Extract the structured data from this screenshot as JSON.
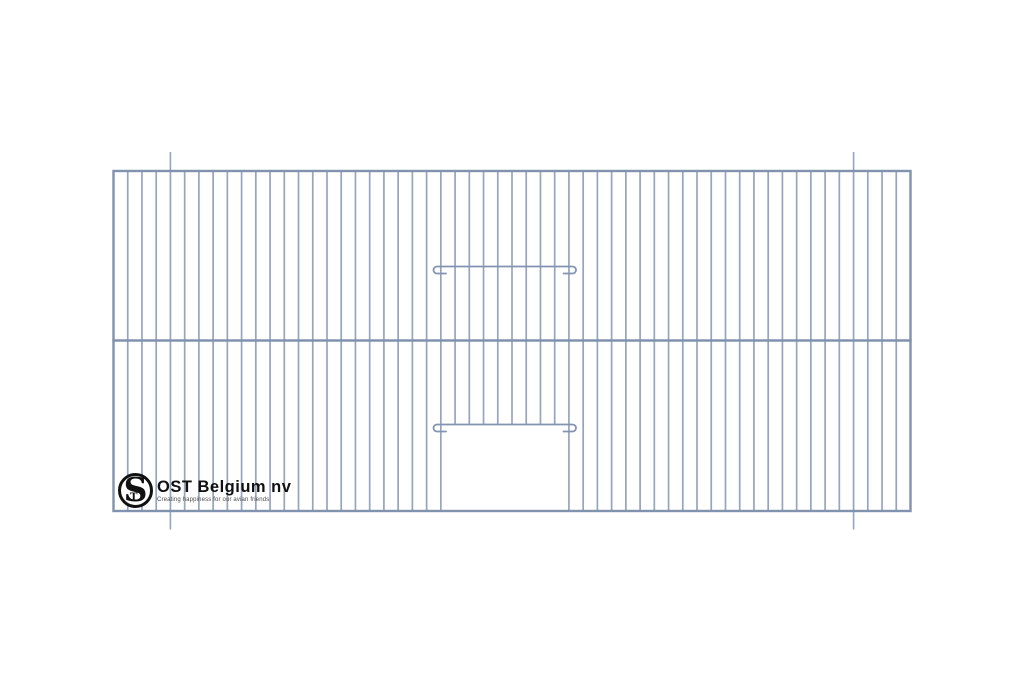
{
  "page": {
    "width": 1024,
    "height": 683,
    "background": "#ffffff"
  },
  "drawing": {
    "title": "cage-front-panel",
    "colors": {
      "frame": "#8192ae",
      "bar": "#96a4bd",
      "wire": "#8294b0",
      "mark": "#93a5c2"
    },
    "frame": {
      "left": 113.5,
      "top": 171,
      "right": 910.5,
      "bottom": 511,
      "stroke_width": 2.4
    },
    "mid_rail": {
      "y": 340.5,
      "stroke_width": 2.6
    },
    "bars": {
      "count": 55,
      "stroke_width": 1.7
    },
    "door": {
      "opening_left": 440.8,
      "opening_right": 568.9,
      "opening_top": 424.5,
      "wire_left": 437,
      "wire_right": 572.5,
      "hook_radius": 3.5,
      "hook_leg": 9,
      "wire_stroke_width": 1.8,
      "wires": [
        {
          "y": 266.5
        },
        {
          "y": 424.5
        }
      ]
    },
    "bend_marks": {
      "xs": [
        170.4,
        853.6
      ],
      "top_y1": 152,
      "top_y2": 171,
      "bottom_y1": 511,
      "bottom_y2": 529.5,
      "stroke_width": 1.6
    }
  },
  "logo": {
    "monogram_s": "S",
    "monogram_t": "T",
    "name": "OST Belgium nv",
    "tagline": "Creating happiness for our avian friends",
    "colors": {
      "ink": "#111111",
      "tagline": "#4a4a4a"
    }
  }
}
